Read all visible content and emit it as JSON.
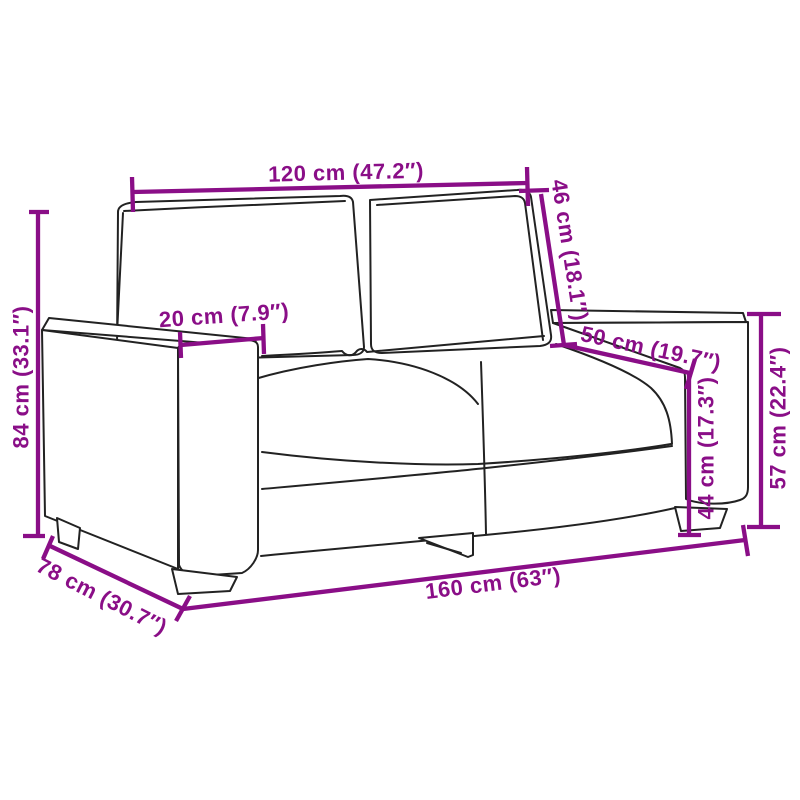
{
  "title": "Two-seater sofa dimension diagram",
  "colors": {
    "dimension": "#8A0E87",
    "outline": "#222222",
    "background": "#ffffff"
  },
  "dimensions": {
    "top_width": {
      "label": "120 cm (47.2″)",
      "value_cm": 120,
      "value_in": 47.2
    },
    "back_height": {
      "label": "46 cm (18.1″)",
      "value_cm": 46,
      "value_in": 18.1
    },
    "armrest_width": {
      "label": "20 cm (7.9″)",
      "value_cm": 20,
      "value_in": 7.9
    },
    "seat_depth": {
      "label": "50 cm (19.7″)",
      "value_cm": 50,
      "value_in": 19.7
    },
    "total_height": {
      "label": "84 cm (33.1″)",
      "value_cm": 84,
      "value_in": 33.1
    },
    "seat_height": {
      "label": "44 cm (17.3″)",
      "value_cm": 44,
      "value_in": 17.3
    },
    "armrest_height": {
      "label": "57 cm (22.4″)",
      "value_cm": 57,
      "value_in": 22.4
    },
    "total_depth": {
      "label": "78 cm (30.7″)",
      "value_cm": 78,
      "value_in": 30.7
    },
    "total_width": {
      "label": "160 cm (63″)",
      "value_cm": 160,
      "value_in": 63
    }
  }
}
